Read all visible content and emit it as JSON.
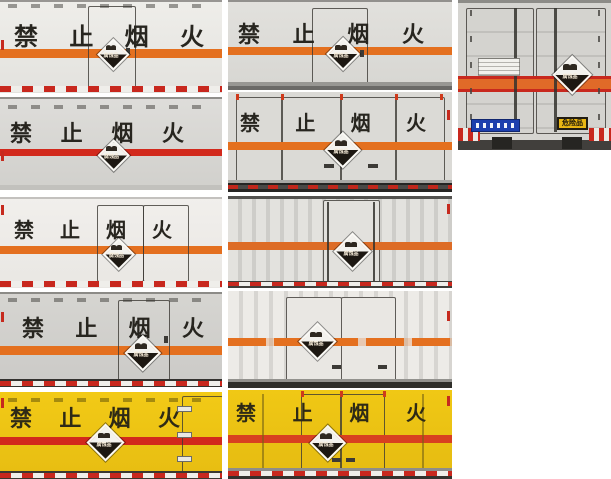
{
  "page": {
    "background": "#ffffff",
    "description": "photo grid of hazardous-goods box truck bodies"
  },
  "ban_chars": [
    "禁",
    "止",
    "烟",
    "火"
  ],
  "ban_text": "禁止烟火",
  "placard": {
    "label": "腐蚀品",
    "icon": "corrosive-diamond-placard"
  },
  "rear": {
    "dangerous_goods_label": "危险品"
  },
  "colors": {
    "orange_stripe": "#e4701f",
    "red_stripe": "#d2291c",
    "yellow_body": "#eec515",
    "gray_body": "#d7d6d2",
    "placard_dark": "#1d1812",
    "reflective_red": "#c8281e",
    "blue_plate": "#1d3fae",
    "dangerous_plate_yellow": "#e9b614"
  },
  "tiles": [
    {
      "name": "side-white-center-door",
      "view": "side",
      "body": "white",
      "stripe": "orange",
      "ban_text": "禁止烟火",
      "placard": true
    },
    {
      "name": "side-white-center-door-2",
      "view": "side",
      "body": "white",
      "stripe": "orange",
      "ban_text": "禁止烟火",
      "placard": true
    },
    {
      "name": "rear-double-doors",
      "view": "rear",
      "body": "gray",
      "stripe": "orange-red band",
      "ban_text": "",
      "placard": true,
      "plates": [
        "blue-company-plate",
        "dangerous-goods-plate"
      ]
    },
    {
      "name": "side-gray",
      "view": "side",
      "body": "gray",
      "stripe": "red",
      "ban_text": "禁止烟火",
      "placard": true
    },
    {
      "name": "rear-double-doors-gray",
      "view": "rear",
      "body": "gray",
      "stripe": "orange",
      "ban_text": "禁止烟火",
      "placard": true
    },
    {
      "name": "side-white-right-doors",
      "view": "side",
      "body": "white",
      "stripe": "orange",
      "ban_text": "禁止烟火",
      "placard": true
    },
    {
      "name": "side-corrugated",
      "view": "side",
      "body": "white-corrugated",
      "stripe": "orange",
      "ban_text": "",
      "placard": true
    },
    {
      "name": "side-gray-right-door",
      "view": "side",
      "body": "gray",
      "stripe": "orange",
      "ban_text": "禁止烟火",
      "placard": true
    },
    {
      "name": "side-corrugated-center-doors",
      "view": "side",
      "body": "white-corrugated",
      "stripe": "orange",
      "ban_text": "",
      "placard": true
    },
    {
      "name": "side-yellow",
      "view": "side",
      "body": "yellow",
      "stripe": "red",
      "ban_text": "禁止烟火",
      "placard": true
    },
    {
      "name": "rear-double-doors-yellow",
      "view": "rear",
      "body": "yellow",
      "stripe": "red",
      "ban_text": "禁止烟火",
      "placard": true
    }
  ]
}
